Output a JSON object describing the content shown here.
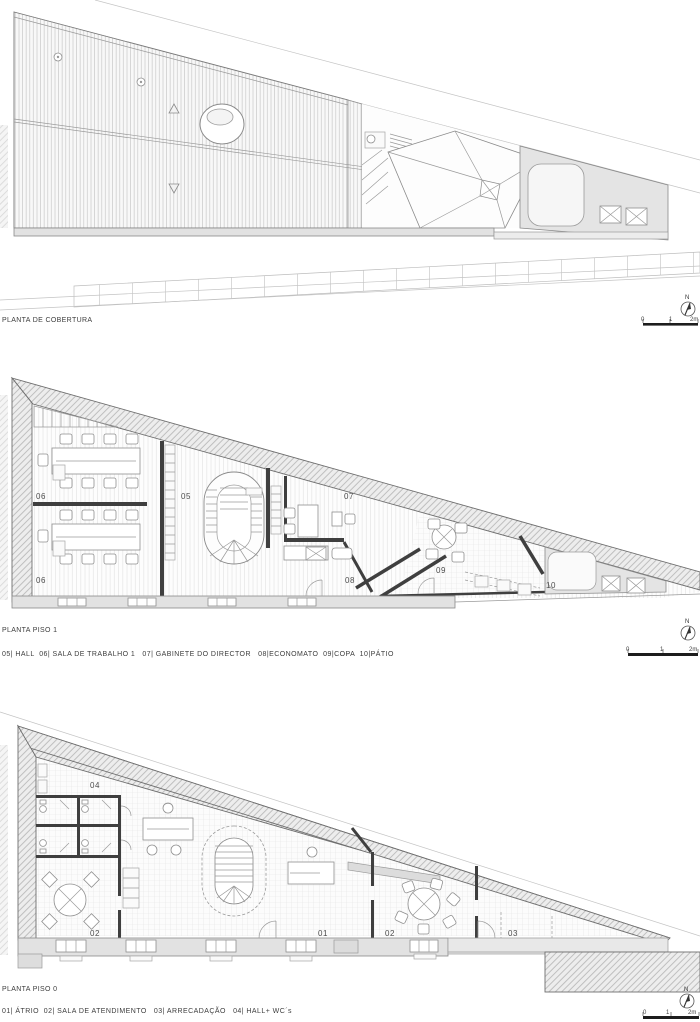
{
  "document": {
    "type": "architectural plan sheet",
    "background": "#ffffff"
  },
  "plans": [
    {
      "title": "PLANTA DE COBERTURA"
    },
    {
      "title": "PLANTA PISO 1",
      "legend": "05| HALL  06| SALA DE TRABALHO 1   07| GABINETE DO DIRECTOR   08|ECONOMATO  09|COPA  10|PÁTIO",
      "room_labels": {
        "hall": "05",
        "sala_trabalho_upper": "06",
        "sala_trabalho_lower": "06",
        "gabinete_director": "07",
        "economato": "08",
        "copa": "09",
        "patio": "10"
      }
    },
    {
      "title": "PLANTA PISO 0",
      "legend": "01| ÁTRIO  02| SALA DE ATENDIMENTO   03| ARRECADAÇÃO   04| HALL+ WC´s",
      "room_labels": {
        "atrio": "01",
        "sala_atendimento_left": "02",
        "sala_atendimento_right": "02",
        "arrecadacao": "03",
        "hall_wc": "04"
      }
    }
  ],
  "compass": {
    "north_label": "N"
  },
  "scale_bar": {
    "tick_0": "0",
    "tick_1": "1",
    "tick_2": "2m"
  },
  "colors": {
    "line": "#8a8a8a",
    "dark_wall": "#3f3f3f",
    "poche_fill": "#ededed",
    "patio_fill": "#e4e4e4",
    "text": "#3d3d3d"
  }
}
